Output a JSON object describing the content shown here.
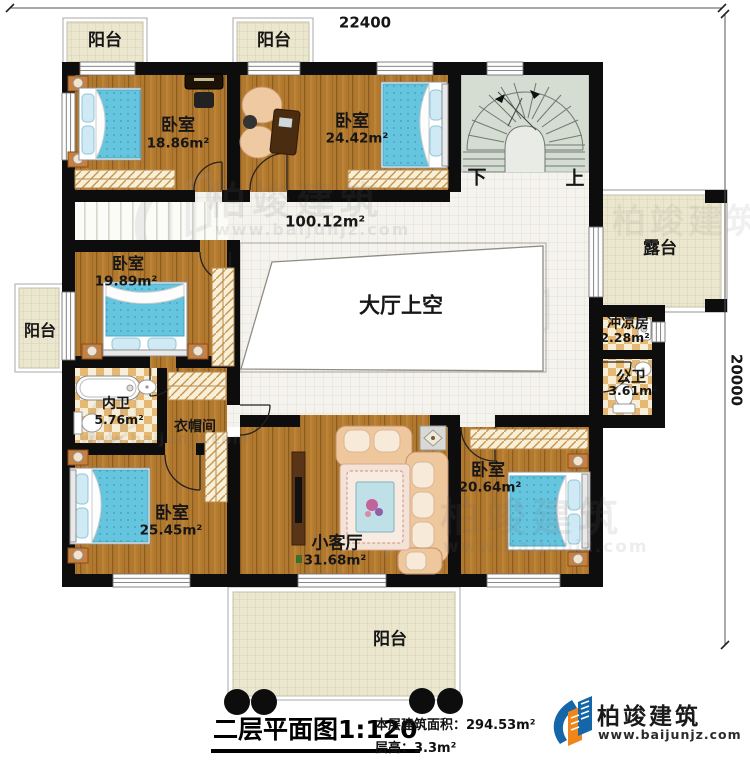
{
  "dimensions": {
    "width": "22400",
    "height": "20000"
  },
  "rooms": {
    "balcony_top_left": {
      "label": "阳台"
    },
    "balcony_top_mid": {
      "label": "阳台"
    },
    "balcony_left": {
      "label": "阳台"
    },
    "balcony_bottom": {
      "label": "阳台"
    },
    "terrace": {
      "label": "露台"
    },
    "bedroom_top_left": {
      "label": "卧室",
      "area": "18.86m²"
    },
    "bedroom_top_mid": {
      "label": "卧室",
      "area": "24.42m²"
    },
    "bedroom_mid_left": {
      "label": "卧室",
      "area": "19.89m²"
    },
    "bedroom_bottom_left": {
      "label": "卧室",
      "area": "25.45m²"
    },
    "bedroom_bottom_right": {
      "label": "卧室",
      "area": "20.64m²"
    },
    "hall": {
      "area": "100.12m²",
      "void_label": "大厅上空"
    },
    "stairs": {
      "down": "下",
      "up": "上"
    },
    "shower": {
      "label": "冲凉房",
      "area": "2.28m²"
    },
    "toilet": {
      "label": "公卫",
      "area": "3.61m²"
    },
    "bath": {
      "label": "内卫",
      "area": "5.76m²"
    },
    "cloakroom": {
      "label": "衣帽间"
    },
    "living": {
      "label": "小客厅",
      "area": "31.68m²"
    }
  },
  "titleblock": {
    "title": "二层平面图1:120",
    "area_line": "本层建筑面积：294.53m²",
    "height_line": "层高：3.3m²"
  },
  "logo": {
    "name": "柏竣建筑",
    "url": "www.baijunjz.com"
  },
  "watermark": {
    "text": "柏竣建筑",
    "url": "www.baijunjz.com"
  },
  "colors": {
    "wall": "#0d0d0d",
    "wood_floor": "#b1782f",
    "cream_tile": "#ebe7cf",
    "hall_tile": "#f4f3ee",
    "stair_floor": "#d5dcd2",
    "bed_blue": "#65c4de",
    "logo_blue": "#1466a8",
    "logo_orange": "#f08619"
  }
}
